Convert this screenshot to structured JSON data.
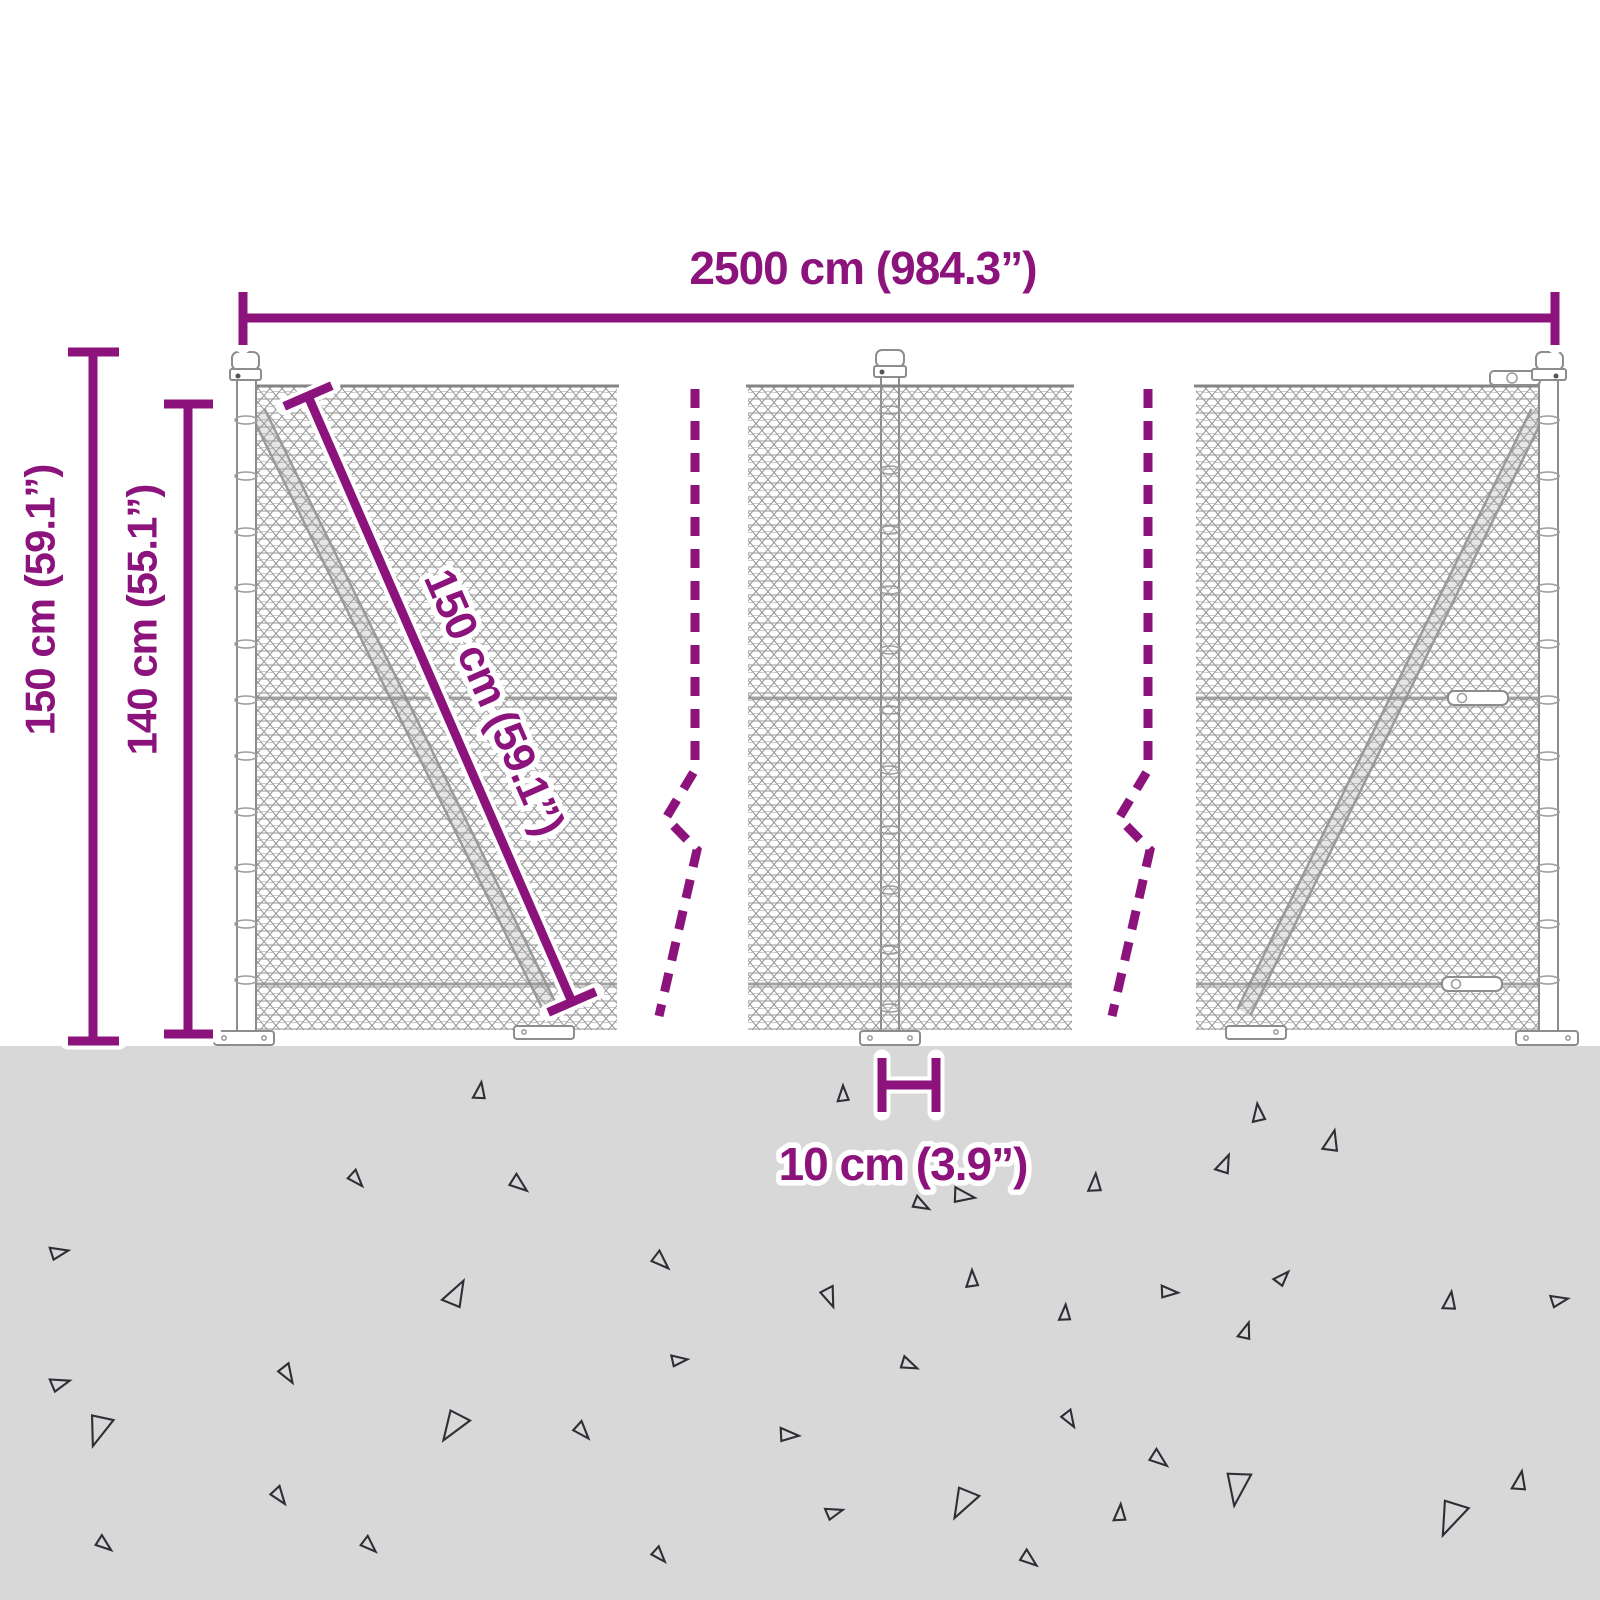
{
  "image": {
    "type": "product dimension diagram",
    "subject": "chain-link wire mesh fence with posts"
  },
  "colors": {
    "accent": "#8C137C",
    "ground": "#D8D8D8",
    "mesh": "#969696",
    "metal": "#8D8D8D",
    "triangle": "#2E2E36",
    "background": "#FFFFFF"
  },
  "dimensions": {
    "total_width": {
      "label": "2500 cm (984.3”)"
    },
    "post_height": {
      "label": "150 cm (59.1”)"
    },
    "mesh_height": {
      "label": "140 cm (55.1”)"
    },
    "diagonal_brace": {
      "label": "150 cm (59.1”)"
    },
    "base_gap": {
      "label": "10 cm (3.9”)"
    }
  },
  "ground": {
    "triangles": [
      {
        "x": 480,
        "y": 1090,
        "s": 16,
        "r": 10
      },
      {
        "x": 843,
        "y": 1093,
        "s": 15,
        "r": 0
      },
      {
        "x": 1258,
        "y": 1112,
        "s": 17,
        "r": -5
      },
      {
        "x": 1332,
        "y": 1140,
        "s": 20,
        "r": 15
      },
      {
        "x": 357,
        "y": 1180,
        "s": 16,
        "r": 140
      },
      {
        "x": 520,
        "y": 1185,
        "s": 18,
        "r": 130
      },
      {
        "x": 1225,
        "y": 1163,
        "s": 18,
        "r": 25
      },
      {
        "x": 1095,
        "y": 1182,
        "s": 17,
        "r": 5
      },
      {
        "x": 965,
        "y": 1196,
        "s": 20,
        "r": 100
      },
      {
        "x": 922,
        "y": 1205,
        "s": 16,
        "r": 120
      },
      {
        "x": 60,
        "y": 1252,
        "s": 17,
        "r": 80
      },
      {
        "x": 662,
        "y": 1262,
        "s": 18,
        "r": 135
      },
      {
        "x": 457,
        "y": 1292,
        "s": 26,
        "r": 30
      },
      {
        "x": 830,
        "y": 1298,
        "s": 19,
        "r": 160
      },
      {
        "x": 1170,
        "y": 1292,
        "s": 16,
        "r": 95
      },
      {
        "x": 1450,
        "y": 1300,
        "s": 17,
        "r": 10
      },
      {
        "x": 1283,
        "y": 1277,
        "s": 15,
        "r": 45
      },
      {
        "x": 972,
        "y": 1278,
        "s": 16,
        "r": 0
      },
      {
        "x": 61,
        "y": 1383,
        "s": 18,
        "r": 75
      },
      {
        "x": 288,
        "y": 1375,
        "s": 18,
        "r": 150
      },
      {
        "x": 680,
        "y": 1360,
        "s": 15,
        "r": 85
      },
      {
        "x": 910,
        "y": 1365,
        "s": 16,
        "r": 115
      },
      {
        "x": 1065,
        "y": 1312,
        "s": 15,
        "r": 5
      },
      {
        "x": 1246,
        "y": 1330,
        "s": 16,
        "r": 20
      },
      {
        "x": 98,
        "y": 1432,
        "s": 30,
        "r": 200
      },
      {
        "x": 452,
        "y": 1428,
        "s": 30,
        "r": 215
      },
      {
        "x": 583,
        "y": 1432,
        "s": 17,
        "r": 140
      },
      {
        "x": 790,
        "y": 1435,
        "s": 18,
        "r": 95
      },
      {
        "x": 1070,
        "y": 1420,
        "s": 16,
        "r": 150
      },
      {
        "x": 1160,
        "y": 1460,
        "s": 18,
        "r": 130
      },
      {
        "x": 280,
        "y": 1497,
        "s": 17,
        "r": 145
      },
      {
        "x": 835,
        "y": 1512,
        "s": 16,
        "r": 75
      },
      {
        "x": 962,
        "y": 1505,
        "s": 30,
        "r": 210
      },
      {
        "x": 1237,
        "y": 1490,
        "s": 32,
        "r": 190
      },
      {
        "x": 1520,
        "y": 1480,
        "s": 18,
        "r": 12
      },
      {
        "x": 105,
        "y": 1545,
        "s": 16,
        "r": 130
      },
      {
        "x": 370,
        "y": 1546,
        "s": 16,
        "r": 135
      },
      {
        "x": 660,
        "y": 1556,
        "s": 15,
        "r": 140
      },
      {
        "x": 1030,
        "y": 1560,
        "s": 17,
        "r": 130
      },
      {
        "x": 1120,
        "y": 1512,
        "s": 16,
        "r": 5
      },
      {
        "x": 1450,
        "y": 1520,
        "s": 34,
        "r": 205
      },
      {
        "x": 1560,
        "y": 1300,
        "s": 16,
        "r": 80
      }
    ]
  }
}
